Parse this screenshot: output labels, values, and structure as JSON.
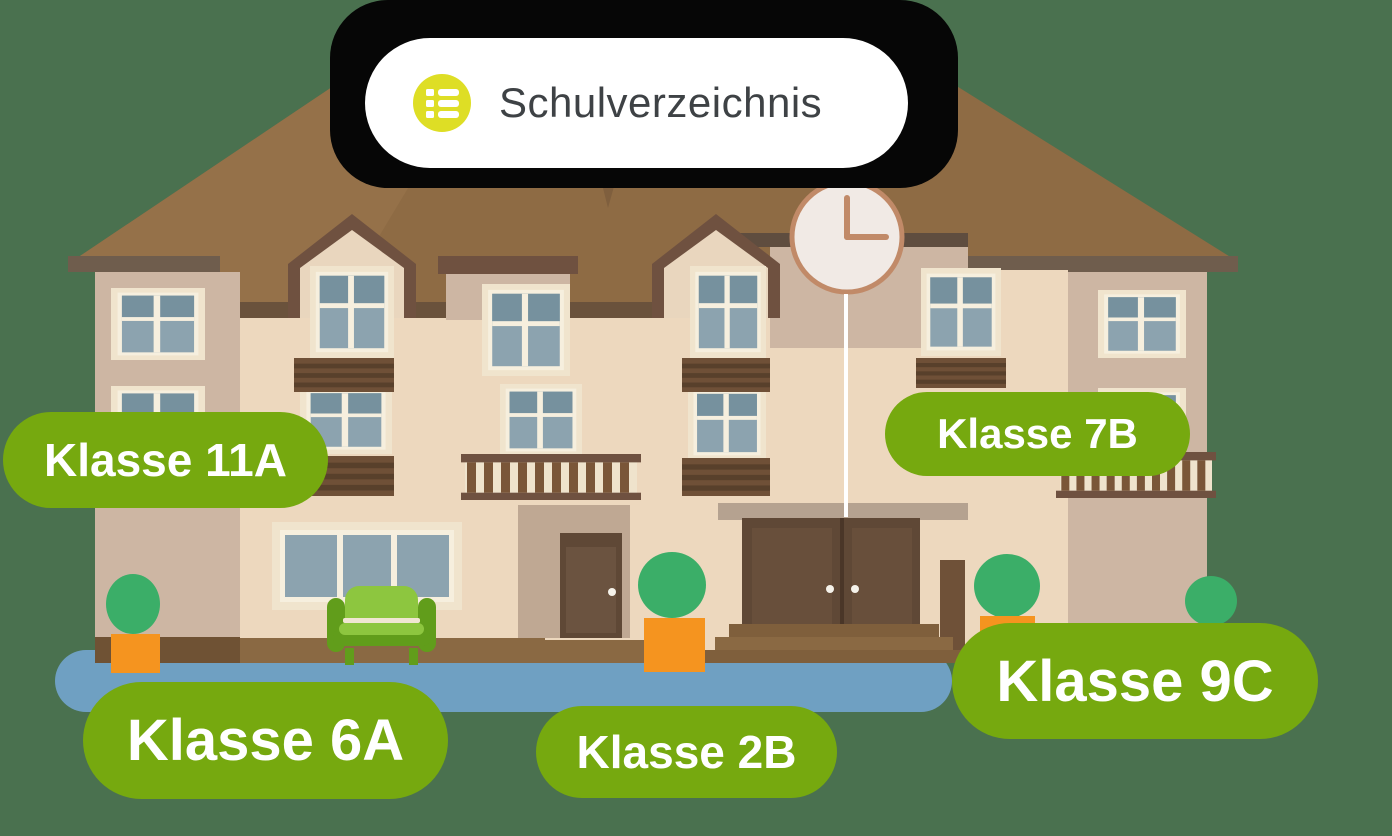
{
  "header": {
    "title": "Schulverzeichnis",
    "icon": "list-icon"
  },
  "labels": [
    {
      "id": "klasse-11a",
      "text": "Klasse 11A"
    },
    {
      "id": "klasse-7b",
      "text": "Klasse 7B"
    },
    {
      "id": "klasse-6a",
      "text": "Klasse 6A"
    },
    {
      "id": "klasse-2b",
      "text": "Klasse 2B"
    },
    {
      "id": "klasse-9c",
      "text": "Klasse 9C"
    }
  ],
  "scene": {
    "type": "school-building-illustration",
    "clock_time": "3:00"
  },
  "colors": {
    "background": "#4A714F",
    "label_pill": "#76A90F",
    "label_text": "#FFFFFF",
    "sign_background": "#FFFFFF",
    "sign_text": "#3E4245",
    "sign_icon": "#DEDE25",
    "sign_shadow": "#060606",
    "roof": "#8E6B44",
    "wall_light": "#EDD8BE",
    "wall_dark": "#CDB6A3",
    "window_pane": "#8CA3AF",
    "door": "#5F4836",
    "path": "#6FA0C2",
    "pot": "#F5941F",
    "bush": "#3BAE68",
    "sofa": "#8DC63F"
  }
}
